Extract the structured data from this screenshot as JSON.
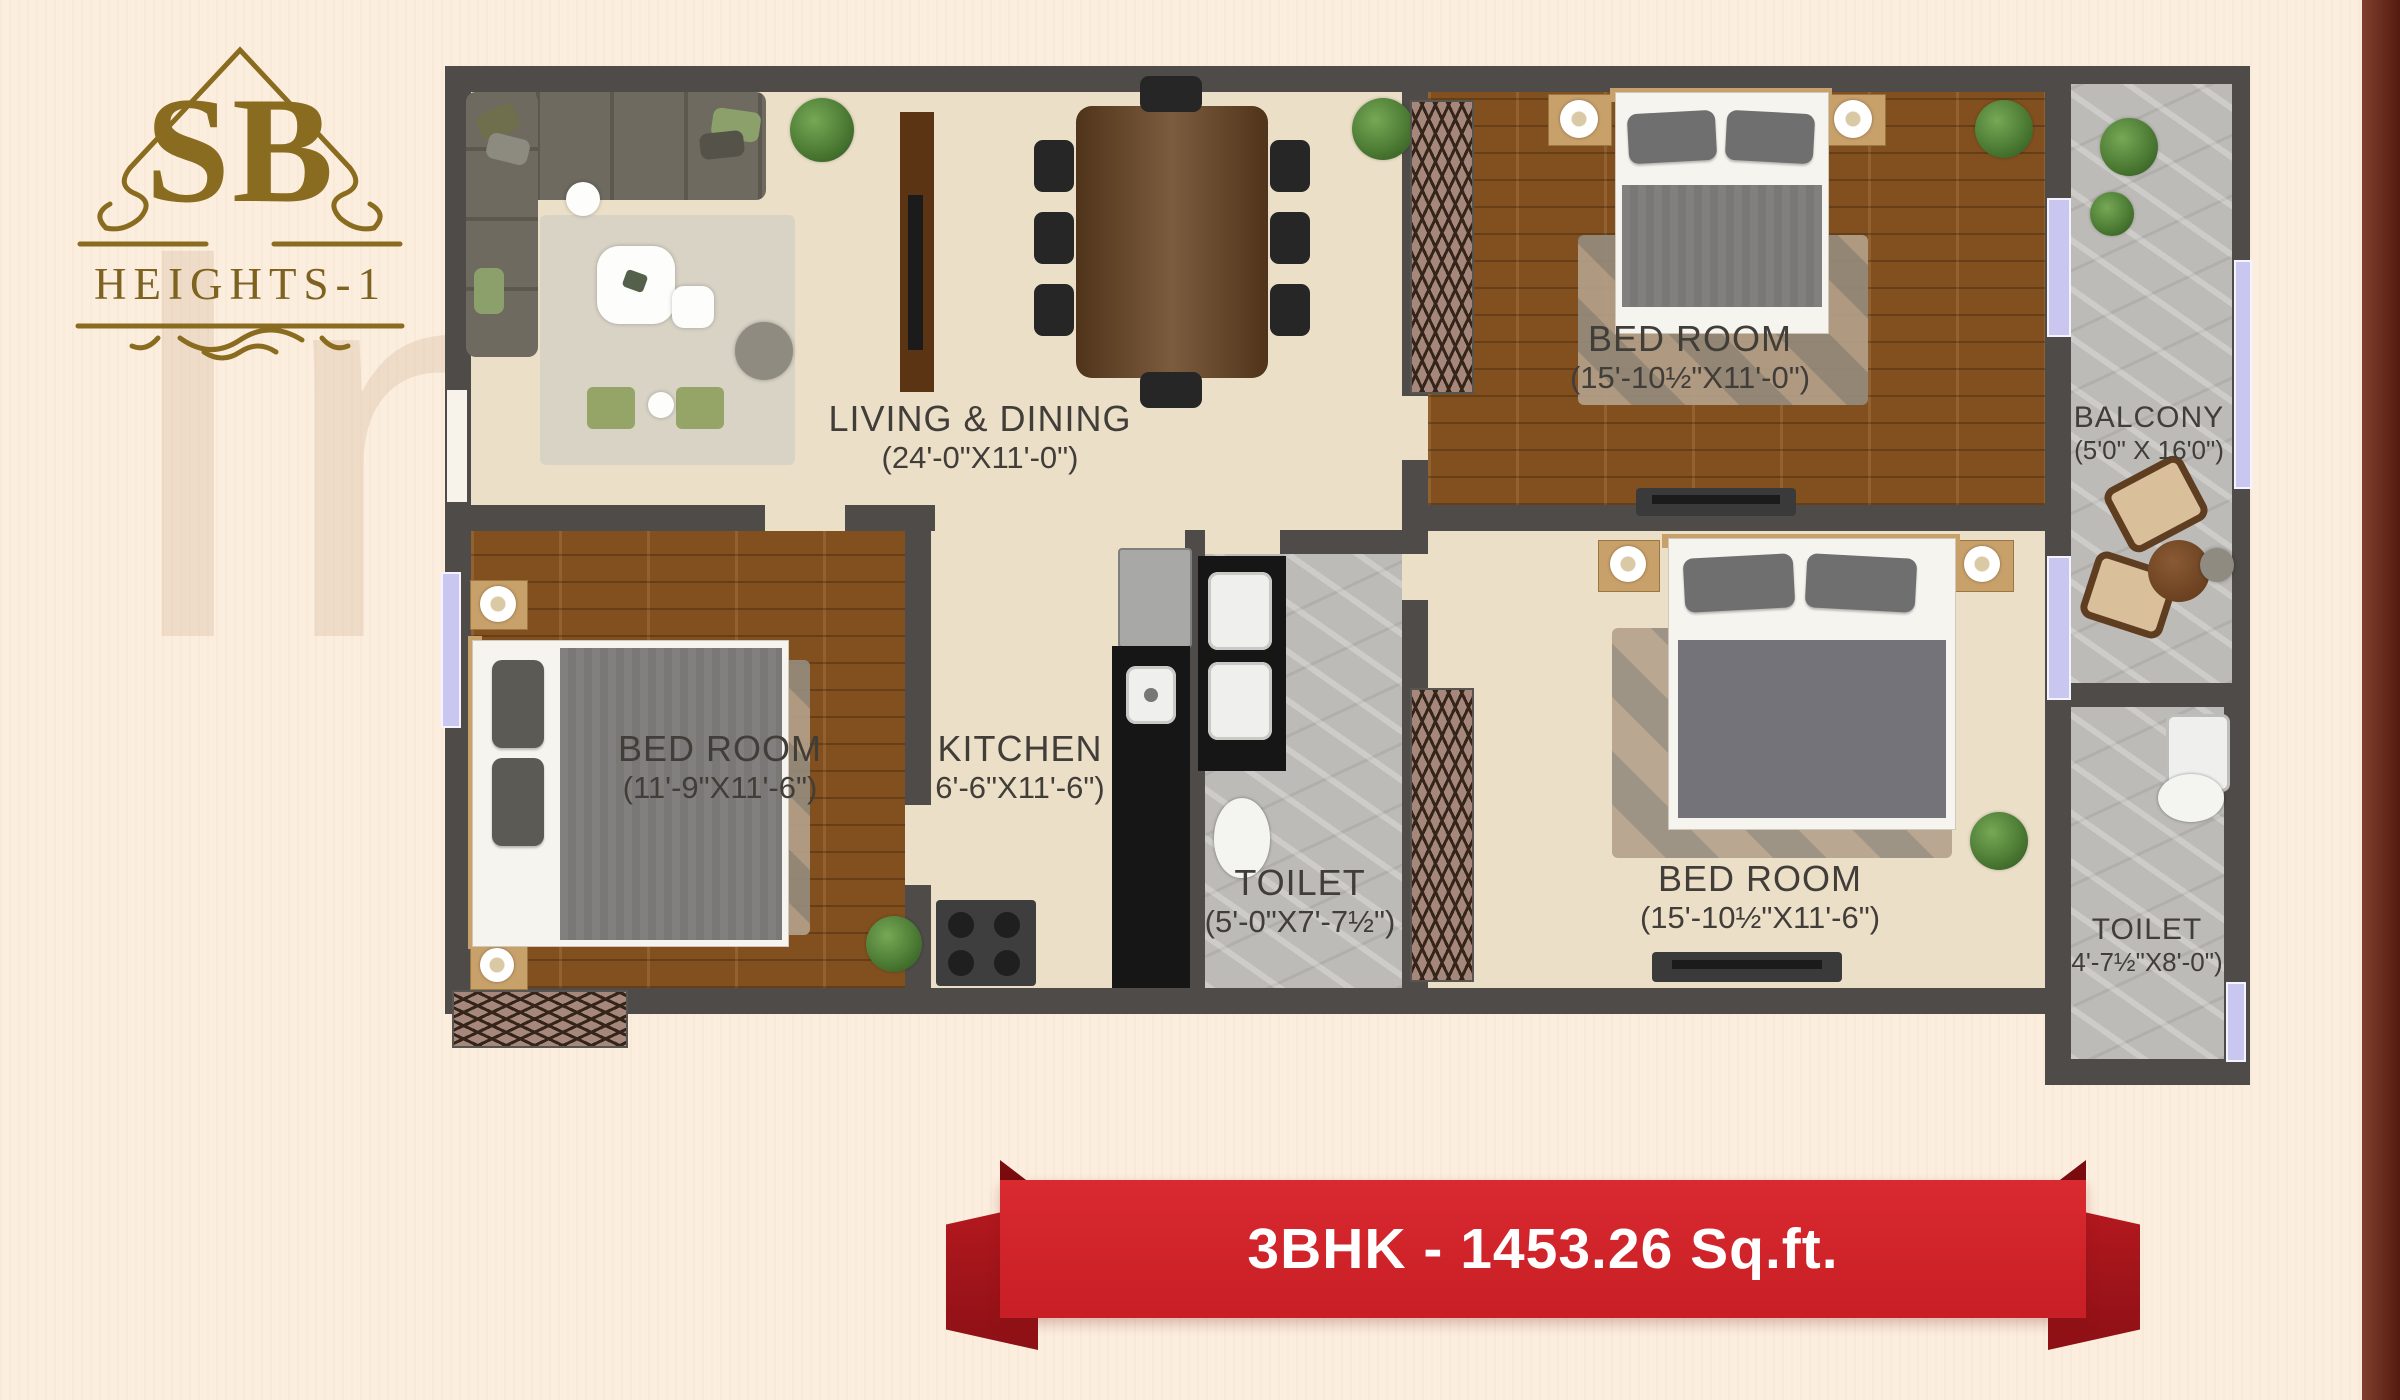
{
  "logo": {
    "monogram": "SB",
    "name": "HEIGHTS-1"
  },
  "watermark": {
    "fragments": [
      "In",
      "st",
      "at"
    ]
  },
  "plan": {
    "rooms": [
      {
        "name": "LIVING & DINING",
        "dims": "(24'-0\"X11'-0\")"
      },
      {
        "name": "BED ROOM",
        "dims": "(15'-10½\"X11'-0\")"
      },
      {
        "name": "BALCONY",
        "dims": "(5'0\" X 16'0\")"
      },
      {
        "name": "BED ROOM",
        "dims": "(11'-9\"X11'-6\")"
      },
      {
        "name": "KITCHEN",
        "dims": "6'-6\"X11'-6\")"
      },
      {
        "name": "TOILET",
        "dims": "(5'-0\"X7'-7½\")"
      },
      {
        "name": "BED ROOM",
        "dims": "(15'-10½\"X11'-6\")"
      },
      {
        "name": "TOILET",
        "dims": "4'-7½\"X8'-0\")"
      }
    ]
  },
  "banner": {
    "label": "3BHK - 1453.26 Sq.ft."
  },
  "colors": {
    "accent_red": "#d0232a",
    "logo_gold": "#8a6c20",
    "wall": "#4e4b49",
    "window": "#c9c7f0"
  }
}
